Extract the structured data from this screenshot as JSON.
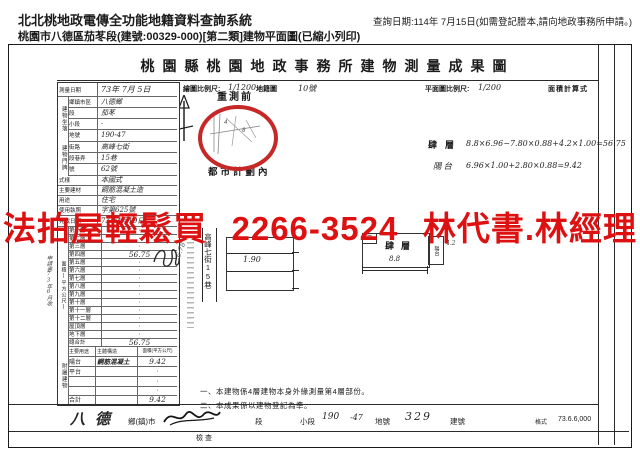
{
  "header": {
    "system_title": "北北桃地政電傳全功能地籍資料查詢系統",
    "query_date": "查詢日期:114年 7月15日(如需登記謄本,請向地政事務所申請。)",
    "doc_line": "桃園市八德區茄苳段(建號:00329-000)[第二類]建物平面圖(已縮小列印)"
  },
  "watermark": {
    "part1": "法拍屋輕鬆買",
    "part2": "2266-3524",
    "part3": "林代書.林經理",
    "color": "#dd1111"
  },
  "doc": {
    "title": "桃園縣桃園地政事務所建物測量成果圖",
    "scale_map_label": "繪圖比例尺:",
    "scale_map_value": "1/1200",
    "scale_map_suffix": "地籍圖",
    "scale_map_sheet": "10號",
    "scale_plan_label": "平面圖比例尺:",
    "scale_plan_value": "1/200",
    "calc_header": "面積計算式",
    "pre_survey": "重測前",
    "urban_plan": "都市計劃內",
    "calc_floor_label": "肆層",
    "calc_floor_formula": "8.8×6.96−7.80×0.88+4.2×1.00=56.75",
    "calc_balcony_label": "陽台",
    "calc_balcony_formula": "6.96×1.00+2.80×0.88=9.42",
    "road_label": "高峰七街15巷",
    "road_side_note": "6.78",
    "left_plan_dim": "1.90",
    "right_plan_label": "肆層",
    "right_plan_dim": "8.8",
    "right_plan_side_dim": "4.2",
    "right_plan_stair": "梯",
    "right_plan_balcony": "陽台",
    "note1": "一、本建物係4層建物本身外緣測量第4層部份。",
    "note2": "二、本成果係以建物登記為準。"
  },
  "form": {
    "survey_date_label": "測量日期",
    "survey_date_value": "73年 7月 5日",
    "sec_location": "建物坐落",
    "sec_address": "建物門牌",
    "rows": [
      {
        "label": "鄉鎮市區",
        "value": "八德鄉"
      },
      {
        "label": "段",
        "value": "茄苳"
      },
      {
        "label": "小段",
        "value": "·"
      },
      {
        "label": "地號",
        "value": "190-47"
      },
      {
        "label": "街路",
        "value": "高峰七街"
      },
      {
        "label": "段巷弄",
        "value": "15巷"
      },
      {
        "label": "號",
        "value": "62號"
      },
      {
        "label": "式樣",
        "value": "本國式"
      },
      {
        "label": "主要建材",
        "value": "鋼筋混凝土造"
      },
      {
        "label": "用途",
        "value": "住宅"
      },
      {
        "label": "使用執照",
        "value": "字第625號"
      },
      {
        "label": "完成日期",
        "value": "73年4月19日"
      }
    ],
    "stamp_note": "申請書73年6月收"
  },
  "floors": {
    "section_label": "面積(平方公尺)",
    "rows": [
      {
        "label": "第一層",
        "value": "·"
      },
      {
        "label": "第二層",
        "value": "·"
      },
      {
        "label": "第三層",
        "value": "·"
      },
      {
        "label": "第四層",
        "value": "56.75"
      },
      {
        "label": "第五層",
        "value": "·"
      },
      {
        "label": "第六層",
        "value": "·"
      },
      {
        "label": "第七層",
        "value": "·"
      },
      {
        "label": "第八層",
        "value": "·"
      },
      {
        "label": "第九層",
        "value": "·"
      },
      {
        "label": "第十層",
        "value": "·"
      },
      {
        "label": "第十一層",
        "value": "·"
      },
      {
        "label": "第十二層",
        "value": "·"
      },
      {
        "label": "屋頂層",
        "value": "·"
      },
      {
        "label": "地下層",
        "value": "·"
      },
      {
        "label": "總合計",
        "value": "56.75"
      }
    ]
  },
  "annex": {
    "section_label": "附屬建物",
    "col1": "主要用途",
    "col2": "主體構造",
    "col3": "面積(平方公尺)",
    "rows": [
      {
        "use": "陽台",
        "structure": "鋼筋混凝土",
        "area": "9.42"
      },
      {
        "use": "平台",
        "structure": "",
        "area": "·"
      },
      {
        "use": "",
        "structure": "",
        "area": "·"
      },
      {
        "use": "",
        "structure": "",
        "area": "·"
      },
      {
        "use": "合計",
        "structure": "",
        "area": "9.42"
      }
    ]
  },
  "footer": {
    "town_value": "八德",
    "town_label": "鄉(鎮)市",
    "check_label": "檢查",
    "seg_label": "段",
    "subseg_label": "小段",
    "subseg_value": "190",
    "lot_value": "-47",
    "lot_label": "地號",
    "bldg_value": "329",
    "bldg_label": "建號",
    "form_label": "格式",
    "print_code": "73.6.6,000"
  }
}
